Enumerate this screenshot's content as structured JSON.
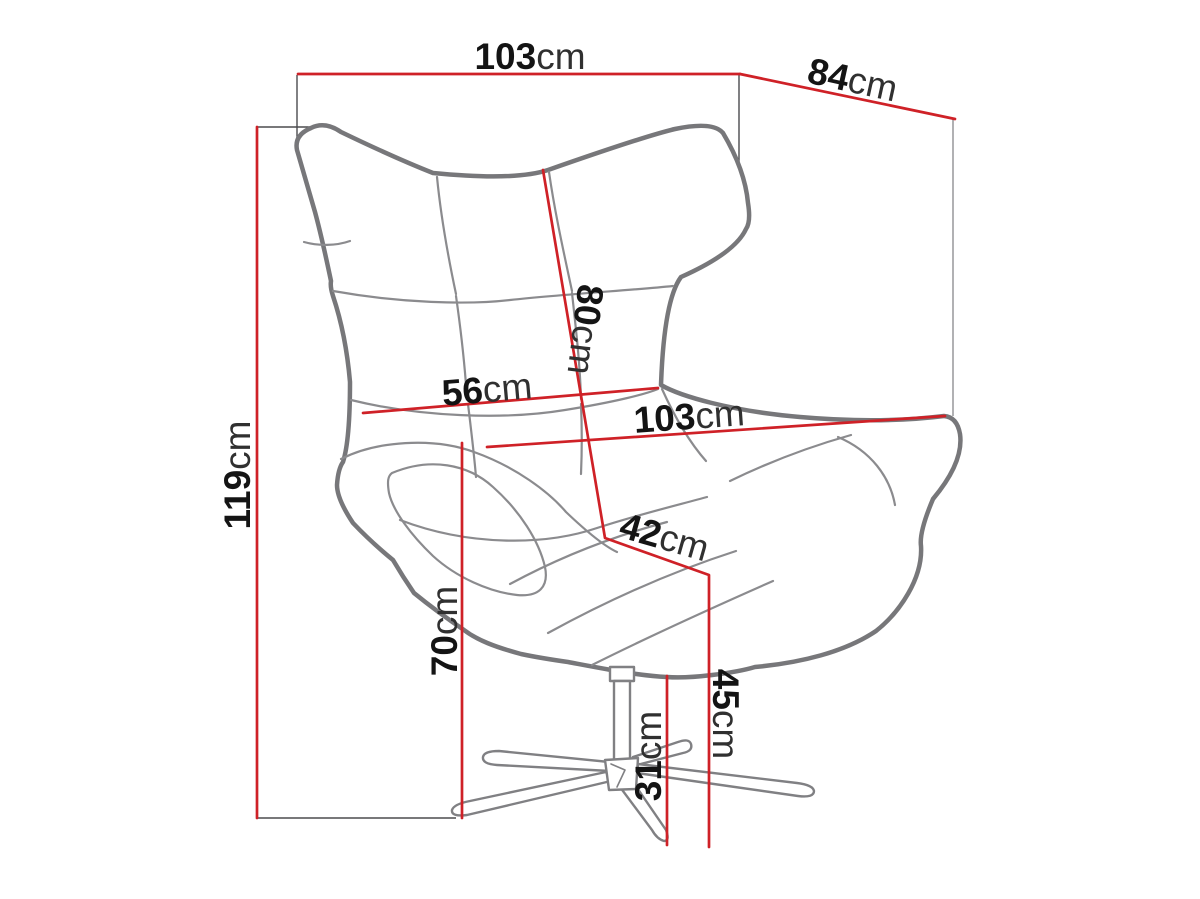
{
  "diagram": {
    "subject": "wingback swivel armchair dimension drawing",
    "unit_suffix": "cm",
    "colors": {
      "dimension_line": "#cf2127",
      "chair_outline": "#77777a",
      "seam_line": "#8b8b8e",
      "extension_line": "#4b4b4e",
      "label_number": "#141414",
      "label_unit": "#303030",
      "background": "#ffffff"
    },
    "dimensions": [
      {
        "name": "overall-width",
        "value": "103",
        "unit": "cm"
      },
      {
        "name": "overall-depth",
        "value": "84",
        "unit": "cm"
      },
      {
        "name": "overall-height",
        "value": "119",
        "unit": "cm"
      },
      {
        "name": "backrest-height",
        "value": "80",
        "unit": "cm"
      },
      {
        "name": "backrest-width",
        "value": "56",
        "unit": "cm"
      },
      {
        "name": "seat-width",
        "value": "103",
        "unit": "cm"
      },
      {
        "name": "seat-depth",
        "value": "42",
        "unit": "cm"
      },
      {
        "name": "armrest-height",
        "value": "70",
        "unit": "cm"
      },
      {
        "name": "seat-height",
        "value": "45",
        "unit": "cm"
      },
      {
        "name": "base-height",
        "value": "31",
        "unit": "cm"
      }
    ]
  }
}
